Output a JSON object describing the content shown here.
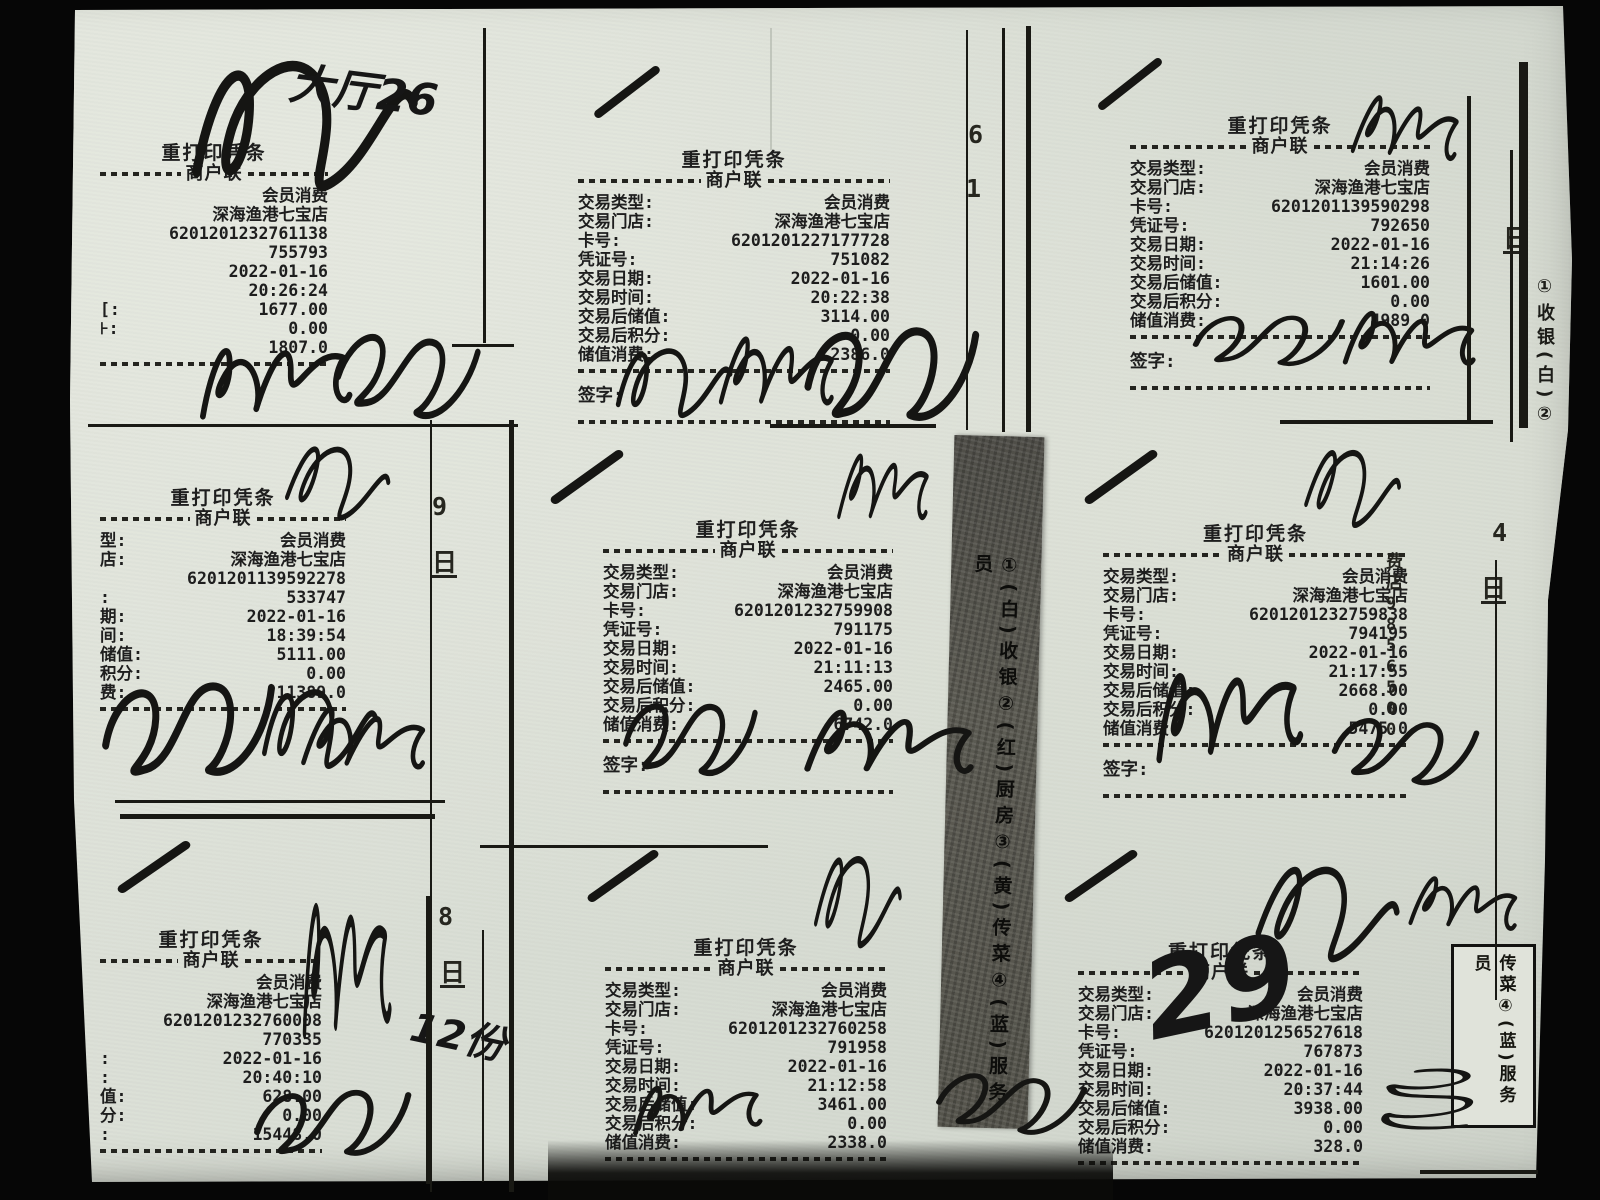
{
  "document": {
    "kind": "scanned-receipt-sheet",
    "store": "深海渔港七宝店",
    "date": "2022-01-16"
  },
  "common": {
    "title": "重打印凭条",
    "copy": "商户联",
    "sign_label": "签字:"
  },
  "field_labels": {
    "type": "交易类型:",
    "shop": "交易门店:",
    "card": "卡号:",
    "voucher": "凭证号:",
    "date": "交易日期:",
    "time": "交易时间:",
    "balance": "交易后储值:",
    "points": "交易后积分:",
    "consume": "储值消费:"
  },
  "receipts": [
    {
      "id": "top-left",
      "sign": false,
      "rows": [
        [
          "",
          "会员消费"
        ],
        [
          "",
          "深海渔港七宝店"
        ],
        [
          "",
          "6201201232761138"
        ],
        [
          "",
          "755793"
        ],
        [
          "",
          "2022-01-16"
        ],
        [
          "",
          "20:26:24"
        ],
        [
          "[:",
          "1677.00"
        ],
        [
          "⊦:",
          "0.00"
        ],
        [
          "",
          "1807.0"
        ]
      ]
    },
    {
      "id": "top-middle",
      "sign": true,
      "rows": [
        [
          "交易类型:",
          "会员消费"
        ],
        [
          "交易门店:",
          "深海渔港七宝店"
        ],
        [
          "卡号:",
          "6201201227177728"
        ],
        [
          "凭证号:",
          "751082"
        ],
        [
          "交易日期:",
          "2022-01-16"
        ],
        [
          "交易时间:",
          "20:22:38"
        ],
        [
          "交易后储值:",
          "3114.00"
        ],
        [
          "交易后积分:",
          "0.00"
        ],
        [
          "储值消费:",
          "2386.0"
        ]
      ]
    },
    {
      "id": "top-right",
      "sign": true,
      "rows": [
        [
          "交易类型:",
          "会员消费"
        ],
        [
          "交易门店:",
          "深海渔港七宝店"
        ],
        [
          "卡号:",
          "6201201139590298"
        ],
        [
          "凭证号:",
          "792650"
        ],
        [
          "交易日期:",
          "2022-01-16"
        ],
        [
          "交易时间:",
          "21:14:26"
        ],
        [
          "交易后储值:",
          "1601.00"
        ],
        [
          "交易后积分:",
          "0.00"
        ],
        [
          "储值消费:",
          "4989.0"
        ]
      ]
    },
    {
      "id": "middle-left",
      "sign": false,
      "rows": [
        [
          "型:",
          "会员消费"
        ],
        [
          "店:",
          "深海渔港七宝店"
        ],
        [
          "",
          "6201201139592278"
        ],
        [
          ":",
          "533747"
        ],
        [
          "期:",
          "2022-01-16"
        ],
        [
          "间:",
          "18:39:54"
        ],
        [
          "储值:",
          "5111.00"
        ],
        [
          "积分:",
          "0.00"
        ],
        [
          "费:",
          "11389.0"
        ]
      ]
    },
    {
      "id": "middle-center",
      "sign": true,
      "rows": [
        [
          "交易类型:",
          "会员消费"
        ],
        [
          "交易门店:",
          "深海渔港七宝店"
        ],
        [
          "卡号:",
          "6201201232759908"
        ],
        [
          "凭证号:",
          "791175"
        ],
        [
          "交易日期:",
          "2022-01-16"
        ],
        [
          "交易时间:",
          "21:11:13"
        ],
        [
          "交易后储值:",
          "2465.00"
        ],
        [
          "交易后积分:",
          "0.00"
        ],
        [
          "储值消费:",
          "6742.0"
        ]
      ]
    },
    {
      "id": "middle-right",
      "sign": true,
      "rows": [
        [
          "交易类型:",
          "会员消费"
        ],
        [
          "交易门店:",
          "深海渔港七宝店"
        ],
        [
          "卡号:",
          "6201201232759838"
        ],
        [
          "凭证号:",
          "794195"
        ],
        [
          "交易日期:",
          "2022-01-16"
        ],
        [
          "交易时间:",
          "21:17:55"
        ],
        [
          "交易后储值:",
          "2668.00"
        ],
        [
          "交易后积分:",
          "0.00"
        ],
        [
          "储值消费:",
          "5475.0"
        ]
      ]
    },
    {
      "id": "bottom-left",
      "sign": false,
      "rows": [
        [
          "",
          "会员消费"
        ],
        [
          "",
          "深海渔港七宝店"
        ],
        [
          "",
          "6201201232760008"
        ],
        [
          "",
          "770335"
        ],
        [
          ":",
          "2022-01-16"
        ],
        [
          ":",
          "20:40:10"
        ],
        [
          "值:",
          "628.00"
        ],
        [
          "分:",
          "0.00"
        ],
        [
          ":",
          "15448.0"
        ]
      ]
    },
    {
      "id": "bottom-middle",
      "sign": false,
      "rows": [
        [
          "交易类型:",
          "会员消费"
        ],
        [
          "交易门店:",
          "深海渔港七宝店"
        ],
        [
          "卡号:",
          "6201201232760258"
        ],
        [
          "凭证号:",
          "791958"
        ],
        [
          "交易日期:",
          "2022-01-16"
        ],
        [
          "交易时间:",
          "21:12:58"
        ],
        [
          "交易后储值:",
          "3461.00"
        ],
        [
          "交易后积分:",
          "0.00"
        ],
        [
          "储值消费:",
          "2338.0"
        ]
      ]
    },
    {
      "id": "bottom-right",
      "sign": false,
      "rows": [
        [
          "交易类型:",
          "会员消费"
        ],
        [
          "交易门店:",
          "深海渔港七宝店"
        ],
        [
          "卡号:",
          "6201201256527618"
        ],
        [
          "凭证号:",
          "767873"
        ],
        [
          "交易日期:",
          "2022-01-16"
        ],
        [
          "交易时间:",
          "20:37:44"
        ],
        [
          "交易后储值:",
          "3938.00"
        ],
        [
          "交易后积分:",
          "0.00"
        ],
        [
          "储值消费:",
          "328.0"
        ]
      ]
    }
  ],
  "strips": {
    "center": "①(白)收银②(红)厨房③(黄)传菜④(蓝)服务员",
    "right_top": "①收银(白)②",
    "bottom_right_box": "传菜④(蓝)服务员"
  },
  "annotations": {
    "hall_note": "大厅26",
    "table_note": "29",
    "portion_note": "12份",
    "margin_digits": [
      "6",
      "1",
      "9",
      "日",
      "8",
      "日",
      "4",
      "日",
      "日"
    ],
    "edge_column": [
      "费",
      "店",
      "9",
      "8",
      "5",
      "6",
      "5",
      "0",
      "0"
    ]
  },
  "colors": {
    "paper": "#d8ddd4",
    "ink": "#1e1e1e",
    "carbon_strip": "#56554e",
    "background": "#060606"
  }
}
